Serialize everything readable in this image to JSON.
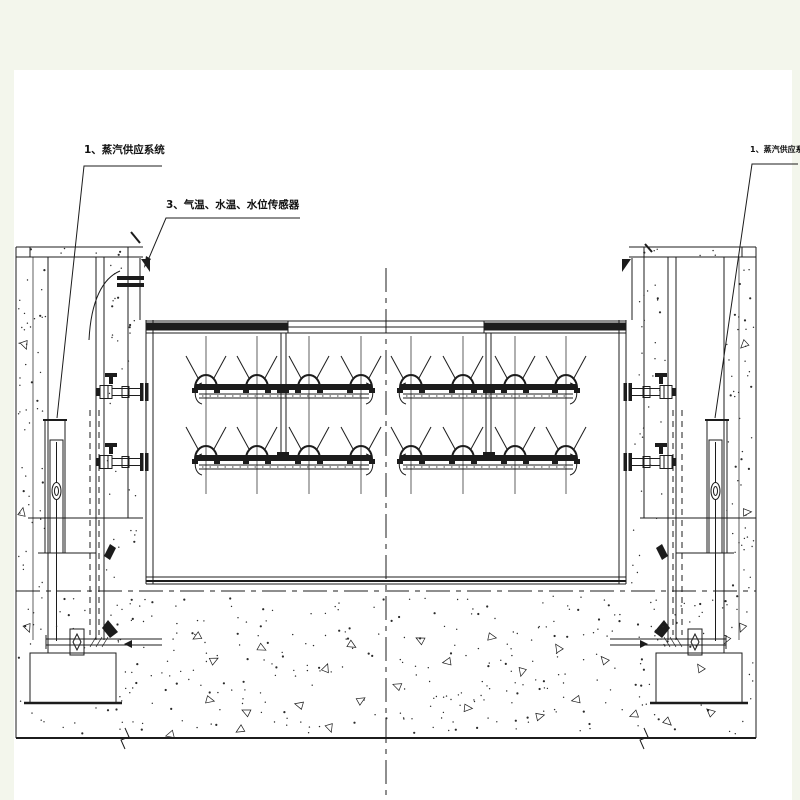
{
  "colors": {
    "page_bg": "#f3f6ec",
    "paper": "#ffffff",
    "ink": "#1c1c1c"
  },
  "callouts": {
    "steam_left": "1、蒸汽供应系统",
    "sensors": "3、气温、水温、水位传感器",
    "steam_right": "1、蒸汽供应系统"
  }
}
